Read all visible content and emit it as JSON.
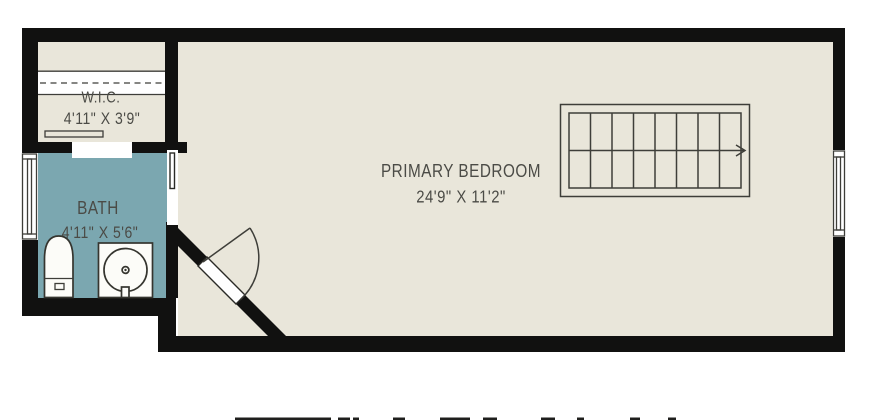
{
  "rooms": {
    "wic": {
      "name": "W.I.C.",
      "dims": "4'11\" X 3'9\""
    },
    "bath": {
      "name": "BATH",
      "dims": "4'11\" X 5'6\""
    },
    "bedroom": {
      "name": "PRIMARY BEDROOM",
      "dims": "24'9\" X 11'2\""
    }
  },
  "stairs": {
    "treads": 8,
    "rows": 2,
    "direction_arrow": "right"
  },
  "colors": {
    "floor": "#e9e6da",
    "bath_floor": "#7ba7b0",
    "wall": "#111110",
    "line": "#3e3e39",
    "text": "#4b4b46",
    "background": "#ffffff"
  }
}
